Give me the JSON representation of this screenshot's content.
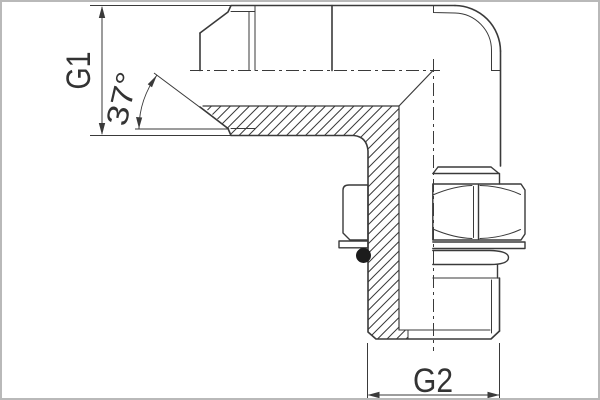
{
  "page": {
    "width": 600,
    "height": 400,
    "background": "#ffffff",
    "border_color": "#b9b9b9"
  },
  "drawing": {
    "kind": "technical line drawing, 90-degree adjustable elbow hydraulic fitting, half section",
    "labels": {
      "g1": "G1",
      "g2": "G2",
      "angle": "37°"
    },
    "colors": {
      "line": "#3a3a3a",
      "text": "#333333",
      "oring_fill": "#1c1c1c",
      "background": "#ffffff"
    }
  }
}
